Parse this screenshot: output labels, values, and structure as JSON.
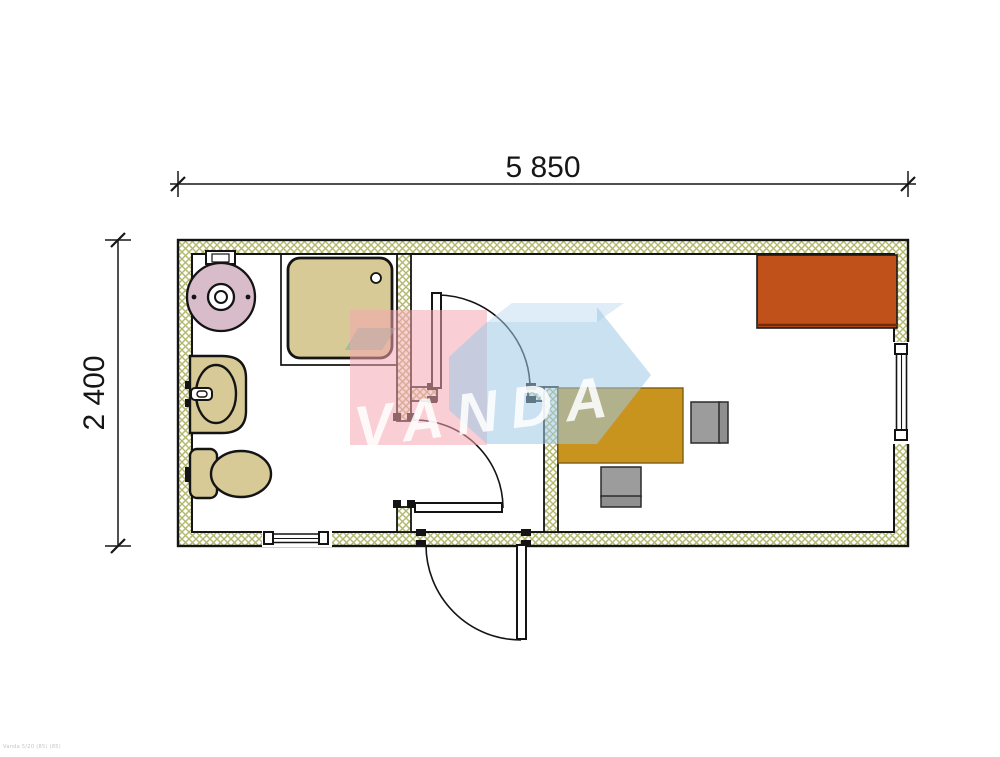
{
  "dimensions": {
    "width_mm": "5 850",
    "height_mm": "2 400"
  },
  "watermark": {
    "brand": "VANDA"
  },
  "footer_note": "Vanda 5/20 (85) (85)",
  "colors": {
    "line": "#141414",
    "wall_hatch": "#b3b86c",
    "sanitary_beige": "#d7ca96",
    "heater_pink": "#d9bcca",
    "desk_gold": "#c8941e",
    "cabinet_orange": "#c0511a",
    "cabinet_shadow": "#6e2c0a",
    "chair_gray": "#9c9c9c",
    "chair_back_gray": "#8f8f8f",
    "watermark_pink": "#f4a6b0",
    "watermark_blue": "#9ec8e6",
    "watermark_lightblue": "#bedcf0",
    "watermark_teal": "#6eaf9b"
  },
  "fixtures": {
    "bathroom": [
      "water-heater",
      "shower-tray",
      "washbasin",
      "toilet"
    ],
    "office": [
      "desk",
      "office-chair",
      "visitor-chair",
      "sideboard-cabinet"
    ]
  }
}
